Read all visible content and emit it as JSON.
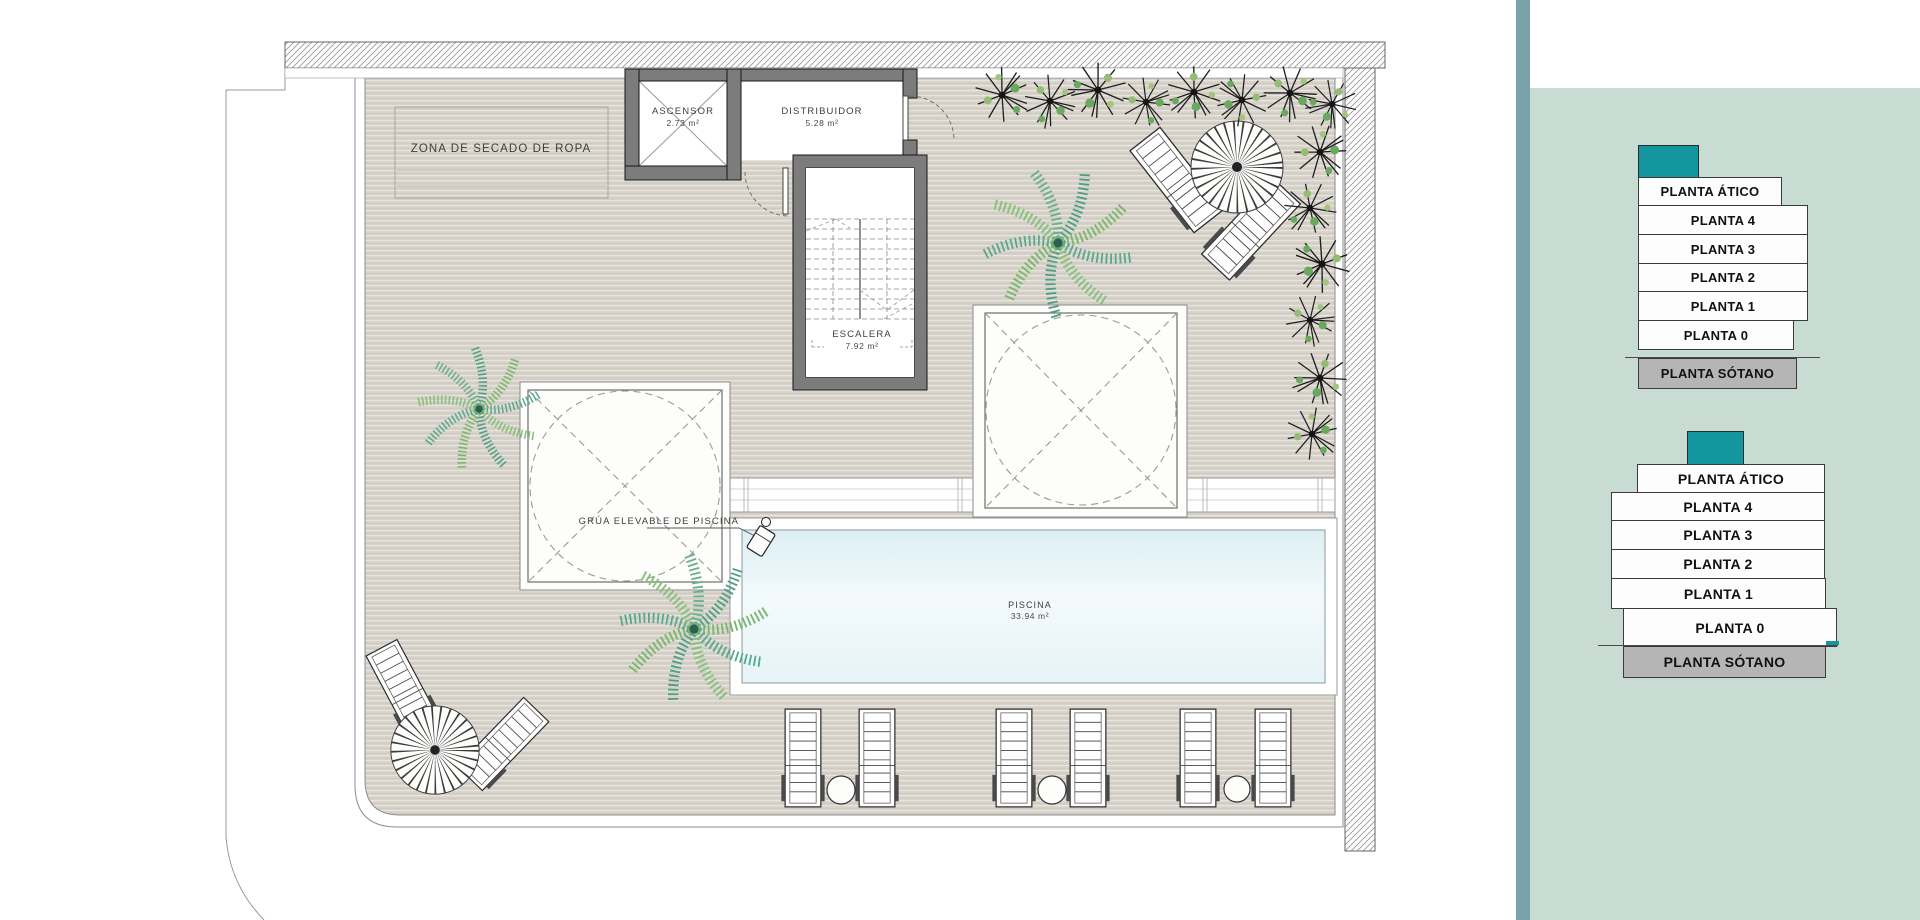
{
  "plan": {
    "labels": {
      "drying_zone": "ZONA DE SECADO DE ROPA",
      "elevator": "ASCENSOR",
      "elevator_area": "2.73 m²",
      "distributor": "DISTRIBUIDOR",
      "distributor_area": "5.28 m²",
      "stairs": "ESCALERA",
      "stairs_area": "7.92 m²",
      "pool_crane": "GRÚA ELEVABLE DE PISCINA",
      "pool": "PISCINA",
      "pool_area": "33.94 m²"
    },
    "colors": {
      "deck": "#d6d2ca",
      "wall_fill": "#7c7c7c",
      "pool_water": "#e8f4f8",
      "plant_teal": "#4f9f85",
      "plant_green": "#79b76c"
    }
  },
  "sidebar": {
    "colors": {
      "background": "#c9dcd4",
      "divider": "#7ba1a9",
      "accent_teal": "#13969e",
      "basement_gray": "#b5b5b5"
    },
    "stacks": [
      {
        "levels": [
          "PLANTA ÁTICO",
          "PLANTA 4",
          "PLANTA 3",
          "PLANTA 2",
          "PLANTA 1",
          "PLANTA 0",
          "PLANTA SÓTANO"
        ]
      },
      {
        "levels": [
          "PLANTA ÁTICO",
          "PLANTA 4",
          "PLANTA 3",
          "PLANTA 2",
          "PLANTA 1",
          "PLANTA 0",
          "PLANTA SÓTANO"
        ]
      }
    ]
  }
}
